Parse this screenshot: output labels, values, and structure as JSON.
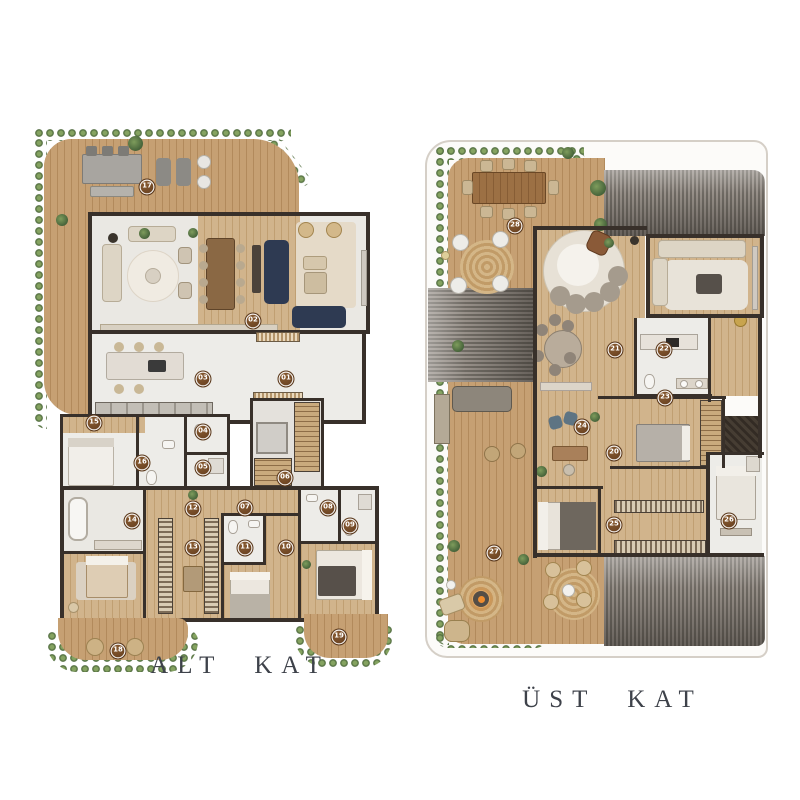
{
  "canvas": {
    "width": 800,
    "height": 800,
    "background": "#ffffff"
  },
  "plans": [
    {
      "id": "alt",
      "label": "ALT KAT",
      "markers": [
        {
          "n": "01",
          "x": 286,
          "y": 379
        },
        {
          "n": "02",
          "x": 253,
          "y": 321
        },
        {
          "n": "03",
          "x": 203,
          "y": 379
        },
        {
          "n": "04",
          "x": 203,
          "y": 432
        },
        {
          "n": "05",
          "x": 203,
          "y": 468
        },
        {
          "n": "06",
          "x": 285,
          "y": 478
        },
        {
          "n": "07",
          "x": 245,
          "y": 508
        },
        {
          "n": "08",
          "x": 328,
          "y": 508
        },
        {
          "n": "09",
          "x": 350,
          "y": 526
        },
        {
          "n": "10",
          "x": 286,
          "y": 548
        },
        {
          "n": "11",
          "x": 245,
          "y": 548
        },
        {
          "n": "12",
          "x": 193,
          "y": 509
        },
        {
          "n": "13",
          "x": 193,
          "y": 548
        },
        {
          "n": "14",
          "x": 132,
          "y": 521
        },
        {
          "n": "15",
          "x": 94,
          "y": 423
        },
        {
          "n": "16",
          "x": 142,
          "y": 463
        },
        {
          "n": "17",
          "x": 147,
          "y": 187
        },
        {
          "n": "18",
          "x": 118,
          "y": 651
        },
        {
          "n": "19",
          "x": 339,
          "y": 637
        }
      ]
    },
    {
      "id": "ust",
      "label": "ÜST KAT",
      "markers": [
        {
          "n": "20",
          "x": 614,
          "y": 453
        },
        {
          "n": "21",
          "x": 615,
          "y": 350
        },
        {
          "n": "22",
          "x": 664,
          "y": 350
        },
        {
          "n": "23",
          "x": 665,
          "y": 398
        },
        {
          "n": "24",
          "x": 582,
          "y": 427
        },
        {
          "n": "25",
          "x": 614,
          "y": 525
        },
        {
          "n": "26",
          "x": 729,
          "y": 521
        },
        {
          "n": "27",
          "x": 494,
          "y": 553
        },
        {
          "n": "28",
          "x": 515,
          "y": 226
        }
      ]
    }
  ],
  "colors": {
    "marker": "#6b4223",
    "wall": "#38302a",
    "deck_wood": "#c6a073",
    "interior_wood": "#d1b48c",
    "white_floor": "#edece8",
    "hedge_green": "#4c683b",
    "roof_gray": "#7c766e",
    "navy_sofa": "#2e3a52",
    "caption_color": "#3e424a"
  }
}
